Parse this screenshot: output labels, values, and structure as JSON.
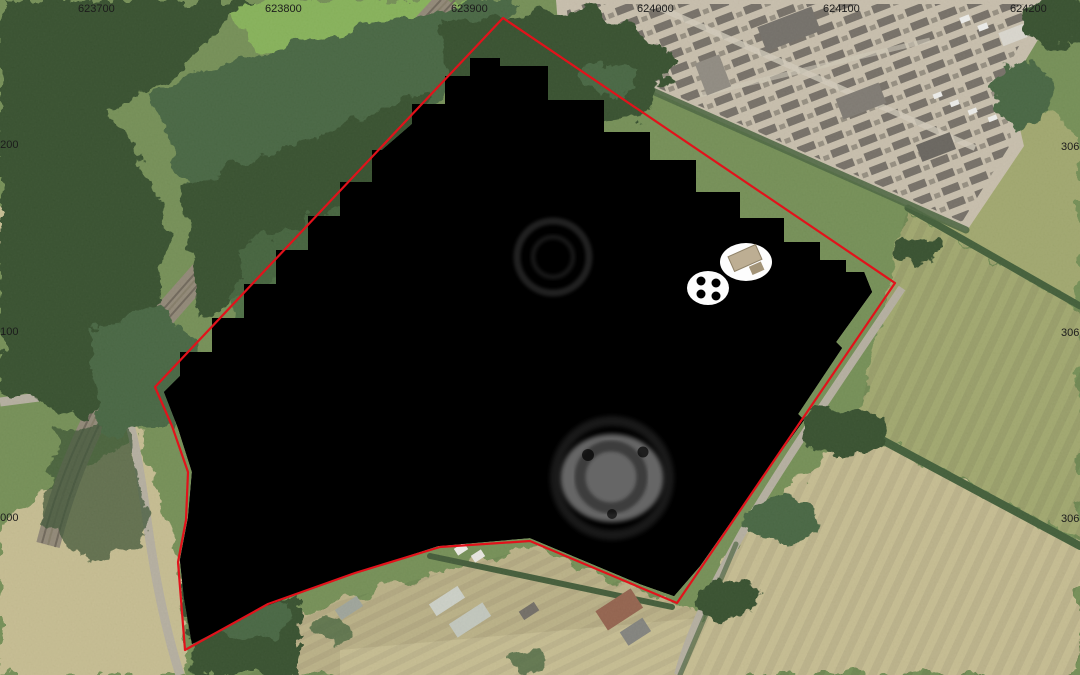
{
  "map": {
    "grid": {
      "top": [
        "623700",
        "623800",
        "623900",
        "624000",
        "624100",
        "624200"
      ],
      "left": [
        "6200",
        "6100",
        "6000"
      ],
      "right": [
        "306",
        "306",
        "306"
      ]
    },
    "colors": {
      "boundary_red": "#e2121b",
      "survey_white": "#fdfdfd",
      "speckle_black": "#000000",
      "woodland_dark": "#2e4827",
      "woodland_mid": "#41603a",
      "grass_green": "#6f8a4f",
      "field_bright": "#82af52",
      "field_olive": "#9da469",
      "field_tan": "#c3b98d",
      "paddock_tan": "#b7ad82",
      "substation_ground": "#c6bca9",
      "equipment_gray": "#4f4b45",
      "road_gray": "#b2ab9c",
      "railway_brown": "#8d8371",
      "hedge_green": "#3a5731",
      "building_gray": "#6e6a63",
      "roof_red": "#8f5c46",
      "label_text": "#1c1c1c"
    }
  }
}
